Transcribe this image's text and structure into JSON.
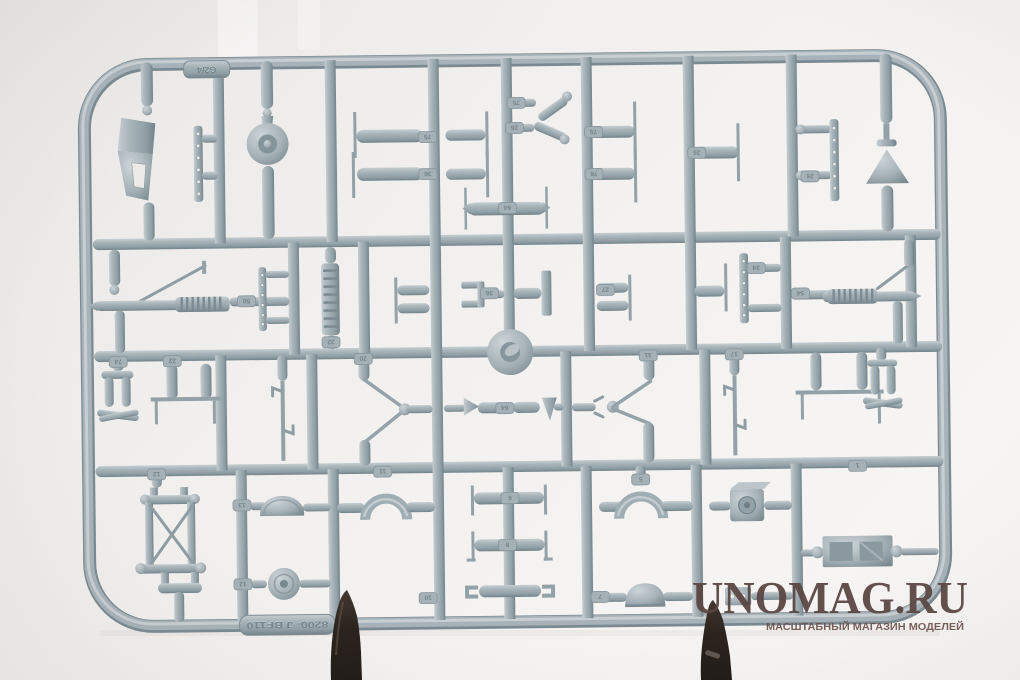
{
  "scene": {
    "description": "Photo of a grey injection-moulded plastic model kit sprue with many small aircraft parts, held upright by two dark clips against a white studio background"
  },
  "palette": {
    "background": "#f1efed",
    "plastic": "#a8b4ba",
    "plastic_highlight": "#cbd3d6",
    "plastic_shadow": "#76868e",
    "clip": "#2b231e",
    "watermark": "#5a4643"
  },
  "watermark": {
    "title": "UNOMAG.RU",
    "subtitle": "МАСШТАБНЫЙ МАГАЗИН МОДЕЛЕЙ"
  },
  "sprue": {
    "corner_tag": "G2/4",
    "mold_tag": "8200- J  BF110",
    "part_tags": [
      "75",
      "36",
      "75",
      "26",
      "64",
      "75",
      "76",
      "26",
      "26",
      "50",
      "22",
      "36",
      "27",
      "24",
      "54",
      "74",
      "22",
      "20",
      "31",
      "17",
      "64",
      "12",
      "13",
      "12",
      "11",
      "5",
      "7",
      "6",
      "8",
      "10",
      "1"
    ]
  }
}
